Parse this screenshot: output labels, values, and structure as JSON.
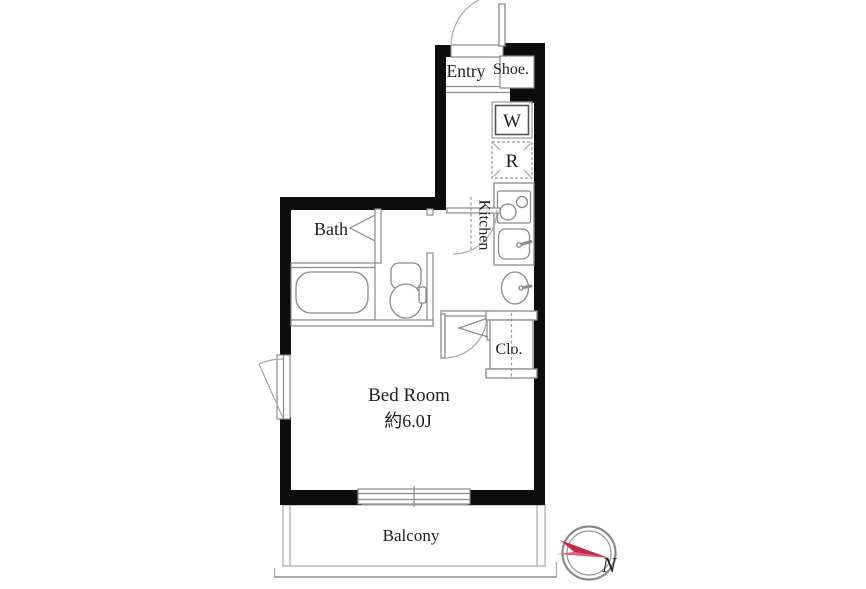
{
  "title": "apartment-floor-plan",
  "colors": {
    "walls": "#0d0d0d",
    "thin_lines": "#8a8a8a",
    "compass_accent": "#c22a4a",
    "compass_accent_light": "#d9627e",
    "background": "#ffffff"
  },
  "rooms": {
    "entry": {
      "label": "Entry"
    },
    "shoe": {
      "label": "Shoe."
    },
    "kitchen": {
      "label": "Kitchen"
    },
    "bath": {
      "label": "Bath"
    },
    "closet": {
      "label": "Clo."
    },
    "bedroom": {
      "label": "Bed Room",
      "size": "約6.0J"
    },
    "balcony": {
      "label": "Balcony"
    }
  },
  "appliances": {
    "washer_label": "W",
    "refrigerator_label": "R"
  },
  "compass": {
    "north_label": "N"
  }
}
